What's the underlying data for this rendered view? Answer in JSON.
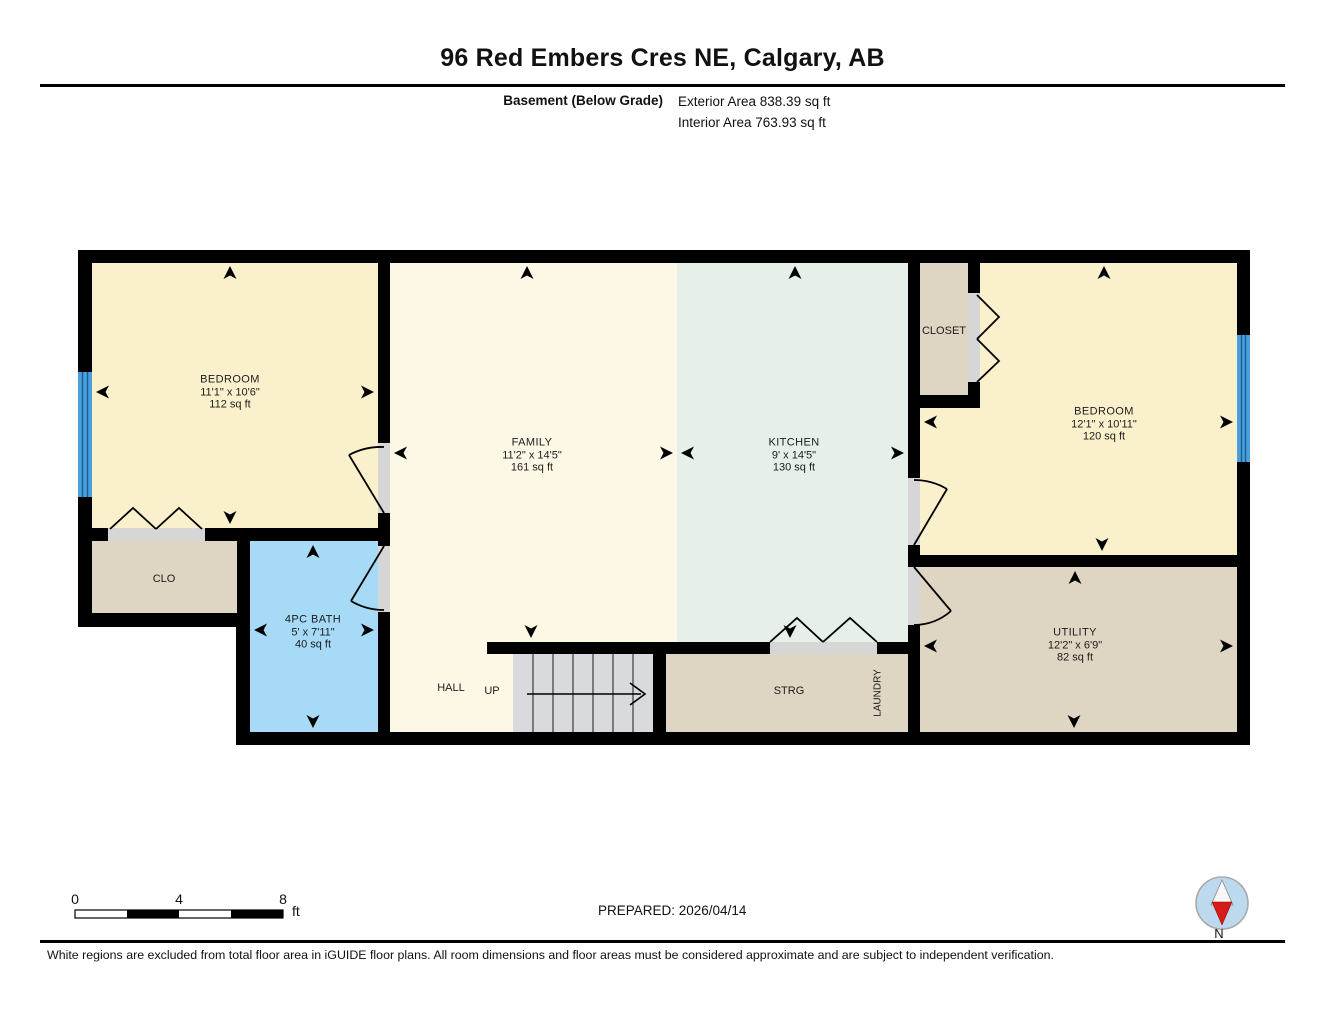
{
  "header": {
    "title": "96 Red Embers Cres NE, Calgary, AB",
    "floor_label": "Basement (Below Grade)",
    "exterior_area": "Exterior Area 838.39 sq ft",
    "interior_area": "Interior Area 763.93 sq ft"
  },
  "rooms": {
    "bedroom_left": {
      "name": "BEDROOM",
      "dims": "11'1\" x 10'6\"",
      "area": "112 sq ft"
    },
    "family": {
      "name": "FAMILY",
      "dims": "11'2\" x 14'5\"",
      "area": "161 sq ft"
    },
    "kitchen": {
      "name": "KITCHEN",
      "dims": "9' x 14'5\"",
      "area": "130 sq ft"
    },
    "closet": {
      "name": "CLOSET"
    },
    "bedroom_right": {
      "name": "BEDROOM",
      "dims": "12'1\" x 10'11\"",
      "area": "120 sq ft"
    },
    "clo": {
      "name": "CLO"
    },
    "bath": {
      "name": "4PC BATH",
      "dims": "5' x 7'11\"",
      "area": "40 sq ft"
    },
    "hall": {
      "name": "HALL"
    },
    "up": {
      "name": "UP"
    },
    "strg": {
      "name": "STRG"
    },
    "laundry": {
      "name": "LAUNDRY"
    },
    "utility": {
      "name": "UTILITY",
      "dims": "12'2\" x 6'9\"",
      "area": "82 sq ft"
    }
  },
  "scale_bar": {
    "tick_0": "0",
    "tick_4": "4",
    "tick_8": "8",
    "unit": "ft"
  },
  "footer": {
    "prepared": "PREPARED: 2026/04/14",
    "compass_label": "N",
    "disclaimer": "White regions are excluded from total floor area in iGUIDE floor plans. All room dimensions and floor areas must be considered approximate and are subject to independent verification."
  },
  "colors": {
    "wall": "#000000",
    "bedroom": "#fbf0cc",
    "family": "#fdf8e6",
    "kitchen": "#e6f0e8",
    "bath": "#a7daf6",
    "tan": "#ded6c2",
    "stairs": "#d9dadd",
    "jamb": "#d6d6d6",
    "window": "#4aa0db",
    "window_line": "#1a5d94",
    "compass_fill": "#bcd9ee",
    "compass_red": "#d71a1a"
  }
}
